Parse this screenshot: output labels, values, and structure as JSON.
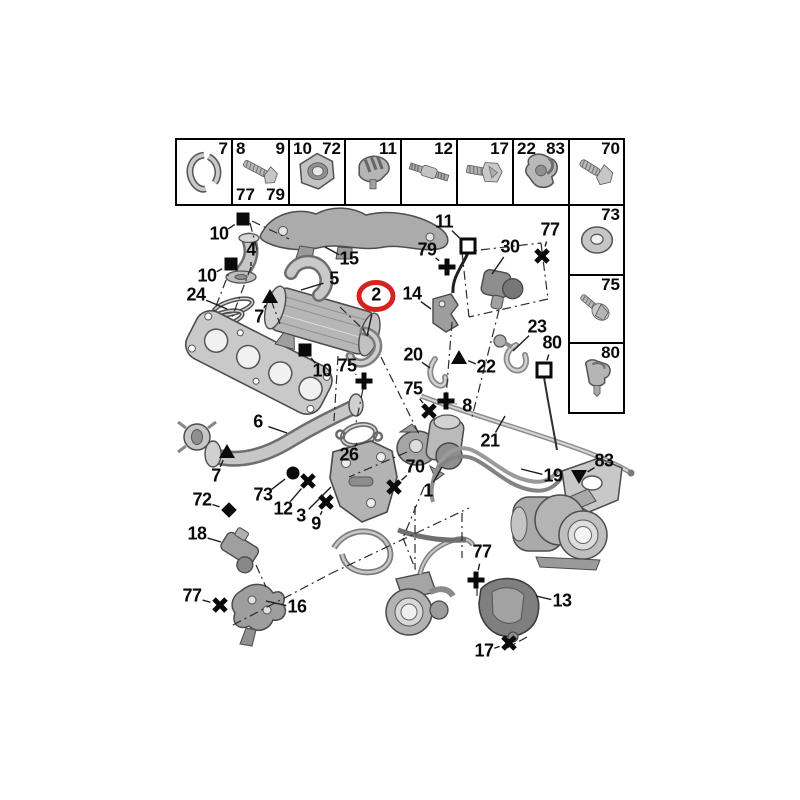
{
  "figure": {
    "background": "#ffffff",
    "highlight_color": "#d42420",
    "label_color": "#0a0a0a",
    "line_color": "#1c1c1c",
    "highlighted_part": "2"
  },
  "fastener_grid": {
    "top_row": [
      {
        "icon": "exhaust-clamp-icon",
        "corner_labels": {
          "tr": "7"
        }
      },
      {
        "icon": "flange-bolt-icon",
        "corner_labels": {
          "tl": "8",
          "tr": "9",
          "bl": "77",
          "br": "79"
        }
      },
      {
        "icon": "flange-nut-icon",
        "corner_labels": {
          "tl": "10",
          "tr": "72"
        }
      },
      {
        "icon": "pipe-clip-icon",
        "corner_labels": {
          "tr": "11"
        }
      },
      {
        "icon": "stud-icon",
        "corner_labels": {
          "tr": "12"
        }
      },
      {
        "icon": "hex-screw-icon",
        "corner_labels": {
          "tr": "17"
        }
      },
      {
        "icon": "retaining-clip-icon",
        "corner_labels": {
          "tl": "22",
          "tr": "83"
        }
      }
    ],
    "right_column": [
      {
        "icon": "screw-icon",
        "corner_labels": {
          "tr": "70"
        }
      },
      {
        "icon": "washer-icon",
        "corner_labels": {
          "tr": "73"
        }
      },
      {
        "icon": "washer-screw-icon",
        "corner_labels": {
          "tr": "75"
        }
      },
      {
        "icon": "push-clip-icon",
        "corner_labels": {
          "tr": "80"
        }
      }
    ]
  },
  "callouts": [
    {
      "label": "10",
      "x": 219,
      "y": 235,
      "sym": "black-square",
      "sx": 243,
      "sy": 219
    },
    {
      "label": "15",
      "x": 349,
      "y": 260,
      "leader": [
        325,
        247
      ]
    },
    {
      "label": "4",
      "x": 251,
      "y": 251,
      "leader": [
        251,
        266
      ]
    },
    {
      "label": "10",
      "x": 207,
      "y": 277,
      "sym": "black-square",
      "sx": 231,
      "sy": 264
    },
    {
      "label": "24",
      "x": 196,
      "y": 296,
      "leader": [
        227,
        309
      ]
    },
    {
      "label": "5",
      "x": 334,
      "y": 280,
      "leader": [
        301,
        290
      ]
    },
    {
      "label": "7",
      "x": 259,
      "y": 318,
      "sym": "triangle-up",
      "sx": 270,
      "sy": 296
    },
    {
      "label": "2",
      "x": 376,
      "y": 296,
      "circled": true,
      "leader": [
        367,
        336
      ]
    },
    {
      "label": "10",
      "x": 322,
      "y": 372,
      "sym": "black-square",
      "sx": 305,
      "sy": 350
    },
    {
      "label": "75",
      "x": 347,
      "y": 367,
      "sym": "plus",
      "sx": 364,
      "sy": 381
    },
    {
      "label": "11",
      "x": 444,
      "y": 223,
      "sym": "white-square",
      "sx": 468,
      "sy": 246
    },
    {
      "label": "79",
      "x": 427,
      "y": 251,
      "sym": "plus",
      "sx": 447,
      "sy": 267
    },
    {
      "label": "77",
      "x": 550,
      "y": 231,
      "sym": "x-mark",
      "sx": 542,
      "sy": 256
    },
    {
      "label": "30",
      "x": 510,
      "y": 248,
      "leader": [
        492,
        274
      ]
    },
    {
      "label": "14",
      "x": 412,
      "y": 295,
      "leader": [
        431,
        309
      ]
    },
    {
      "label": "23",
      "x": 537,
      "y": 328,
      "leader": [
        513,
        351
      ]
    },
    {
      "label": "80",
      "x": 552,
      "y": 344,
      "sym": "white-square",
      "sx": 544,
      "sy": 370
    },
    {
      "label": "20",
      "x": 413,
      "y": 356,
      "leader": [
        430,
        368
      ]
    },
    {
      "label": "22",
      "x": 486,
      "y": 368,
      "sym": "triangle-up",
      "sx": 459,
      "sy": 357
    },
    {
      "label": "75",
      "x": 413,
      "y": 390,
      "sym": "x-mark",
      "sx": 429,
      "sy": 411
    },
    {
      "label": "8",
      "x": 467,
      "y": 407,
      "sym": "plus",
      "sx": 446,
      "sy": 401
    },
    {
      "label": "26",
      "x": 349,
      "y": 456,
      "leader": [
        357,
        443
      ]
    },
    {
      "label": "70",
      "x": 415,
      "y": 468,
      "sym": "x-mark",
      "sx": 394,
      "sy": 487
    },
    {
      "label": "1",
      "x": 428,
      "y": 492,
      "leader": [
        442,
        467
      ]
    },
    {
      "label": "21",
      "x": 490,
      "y": 442,
      "leader": [
        505,
        416
      ]
    },
    {
      "label": "6",
      "x": 258,
      "y": 423,
      "leader": [
        287,
        433
      ]
    },
    {
      "label": "7",
      "x": 216,
      "y": 477,
      "sym": "triangle-up",
      "sx": 227,
      "sy": 451
    },
    {
      "label": "73",
      "x": 263,
      "y": 496,
      "sym": "circle",
      "sx": 293,
      "sy": 473
    },
    {
      "label": "12",
      "x": 283,
      "y": 510,
      "sym": "x-mark",
      "sx": 308,
      "sy": 481
    },
    {
      "label": "3",
      "x": 301,
      "y": 517,
      "leader": [
        331,
        487
      ]
    },
    {
      "label": "9",
      "x": 316,
      "y": 525,
      "sym": "x-mark",
      "sx": 326,
      "sy": 502
    },
    {
      "label": "72",
      "x": 202,
      "y": 501,
      "sym": "diamond",
      "sx": 229,
      "sy": 510
    },
    {
      "label": "18",
      "x": 197,
      "y": 535,
      "leader": [
        221,
        542
      ]
    },
    {
      "label": "77",
      "x": 192,
      "y": 597,
      "sym": "x-mark",
      "sx": 220,
      "sy": 605
    },
    {
      "label": "16",
      "x": 297,
      "y": 608,
      "leader": [
        266,
        601
      ]
    },
    {
      "label": "19",
      "x": 553,
      "y": 477,
      "leader": [
        521,
        469
      ]
    },
    {
      "label": "83",
      "x": 604,
      "y": 462,
      "sym": "triangle-down",
      "sx": 579,
      "sy": 477
    },
    {
      "label": "77",
      "x": 482,
      "y": 553,
      "sym": "plus",
      "sx": 476,
      "sy": 580
    },
    {
      "label": "13",
      "x": 562,
      "y": 602,
      "leader": [
        536,
        596
      ]
    },
    {
      "label": "17",
      "x": 484,
      "y": 652,
      "sym": "x-mark",
      "sx": 509,
      "sy": 643
    }
  ]
}
